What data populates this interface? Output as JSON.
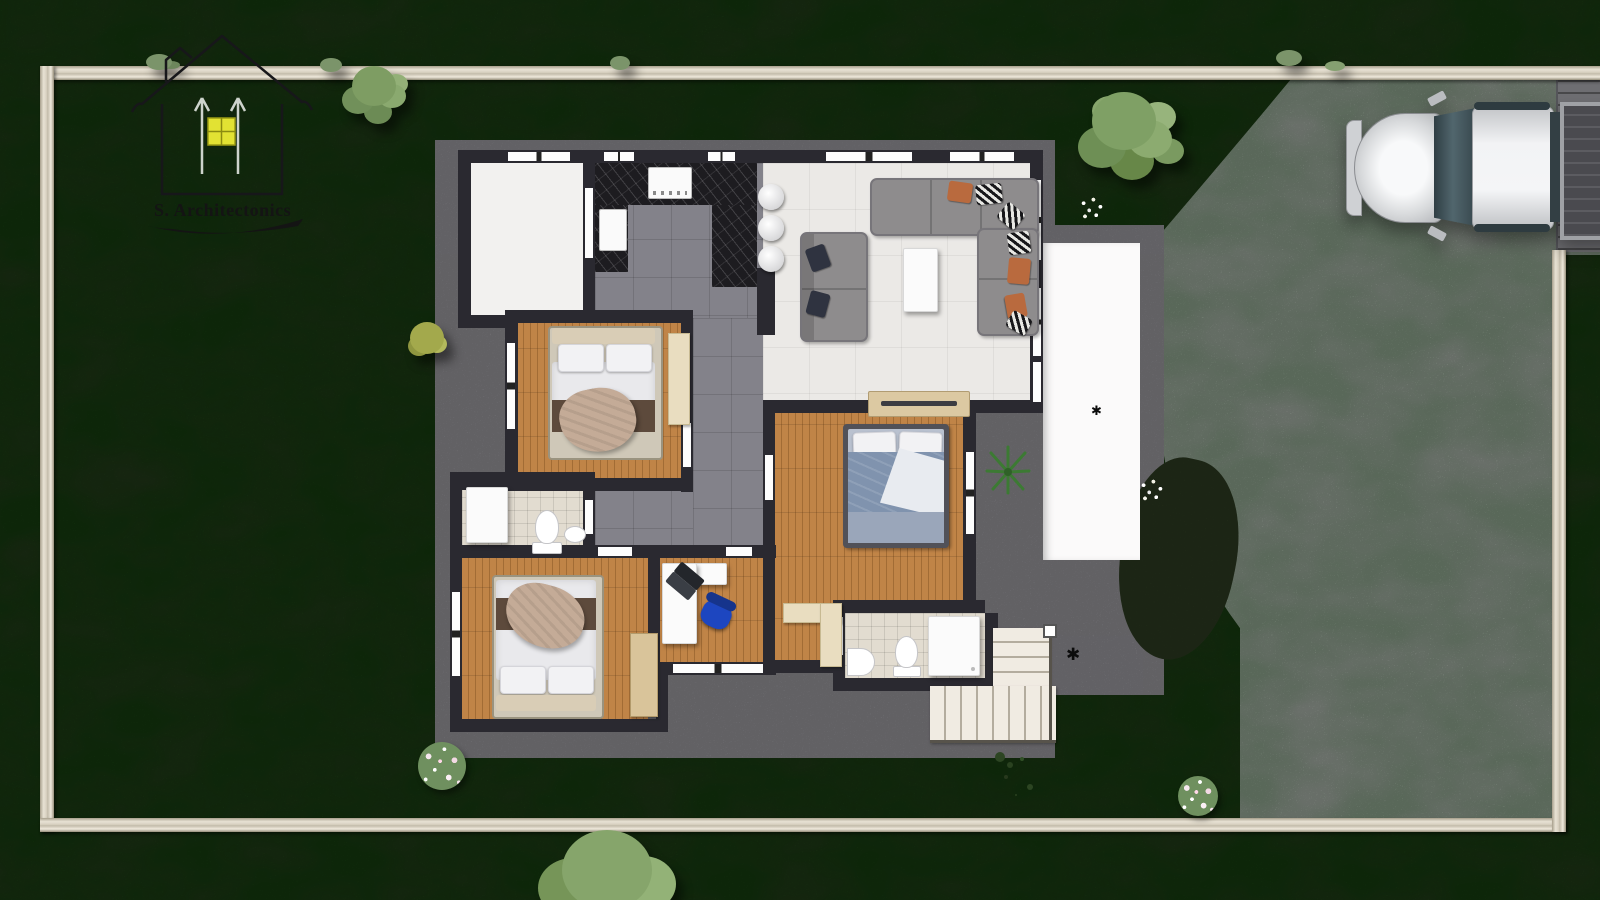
{
  "palette": {
    "grass": "#2e3d22",
    "wallStone": "#ded8ca",
    "driveway": "#c9c6c9",
    "slab": "#8d8c91",
    "houseWall": "#2a2930",
    "wood": "#c08447",
    "tileGray": "#83828a",
    "livingFloor": "#ebe9e6",
    "terrace": "#fbfafa",
    "marble": "#1d1c20",
    "bathTile": "#e2dcd0",
    "sofa": "#8e8c8d",
    "pillowRust": "#b96a3e",
    "bedWhite": "#e9e9ec",
    "bedBlue": "#8093ae",
    "blanketBeige": "#c4ab97",
    "runnerBrown": "#5d4a3c",
    "closetCream": "#e9ddc0",
    "wardrobeWood": "#d9c49a",
    "chairBlue": "#1d46c0",
    "stairs": "#f0ebe2",
    "carSilver": "#d9dadc",
    "gate": "#6e6e72",
    "logoYellow": "#e2e233"
  },
  "logo": {
    "text": "S. Architectonics",
    "mark": "house outline with yellow window and two upward arrows, swoosh underline"
  },
  "site": {
    "view": "top-down architectural site plan render",
    "boundary": "stone perimeter wall",
    "lawn": "dark green grass",
    "driveway": "light flagstone paving, right side, entrance at top right",
    "vehicle": {
      "type": "pickup-truck",
      "color": "silver",
      "location": "driveway top right",
      "facing": "left"
    },
    "plants": [
      "round tree over top wall (left)",
      "large tree between house and driveway (top right)",
      "large tree at bottom edge (center)",
      "yellow-green shrub on left lawn",
      "pink flower bush bottom-left lawn",
      "white flower bush on lawn right of driveway edge",
      "white flower cluster near driveway curve",
      "white flower cluster on grass bulge",
      "agave plant beside terrace",
      "dark grass sprigs below house"
    ]
  },
  "house": {
    "rooms": [
      {
        "name": "garage-empty-room",
        "floor": "white"
      },
      {
        "name": "kitchen",
        "floor": "gray tile",
        "features": [
          "black marble U counter",
          "cooktop",
          "prep board",
          "3 round bar stools"
        ]
      },
      {
        "name": "living-room",
        "floor": "light tile",
        "features": [
          "L-sectional sofa with rust and striped pillows",
          "two-seat sofa with navy pillows",
          "white coffee table",
          "wood media console"
        ]
      },
      {
        "name": "bedroom-1",
        "floor": "wood",
        "features": [
          "double bed white linens, brown runner, taupe throw",
          "cream wardrobe"
        ]
      },
      {
        "name": "master-bedroom",
        "floor": "wood",
        "features": [
          "double bed blue bedding",
          "cream corner closet"
        ]
      },
      {
        "name": "bedroom-2",
        "floor": "wood",
        "features": [
          "double bed white linens, brown runner, taupe throw",
          "wood wardrobe"
        ]
      },
      {
        "name": "study",
        "floor": "wood",
        "features": [
          "white L-desk",
          "laptop",
          "blue office chair"
        ]
      },
      {
        "name": "bathroom-1",
        "floor": "beige tile",
        "features": [
          "shower",
          "toilet",
          "sink"
        ]
      },
      {
        "name": "master-bathroom",
        "floor": "beige tile",
        "features": [
          "shower",
          "toilet",
          "corner sink"
        ]
      },
      {
        "name": "hallway",
        "floor": "gray tile"
      },
      {
        "name": "terrace",
        "floor": "white, with floor drain"
      },
      {
        "name": "exterior-stairs",
        "location": "bottom right of house"
      }
    ]
  }
}
